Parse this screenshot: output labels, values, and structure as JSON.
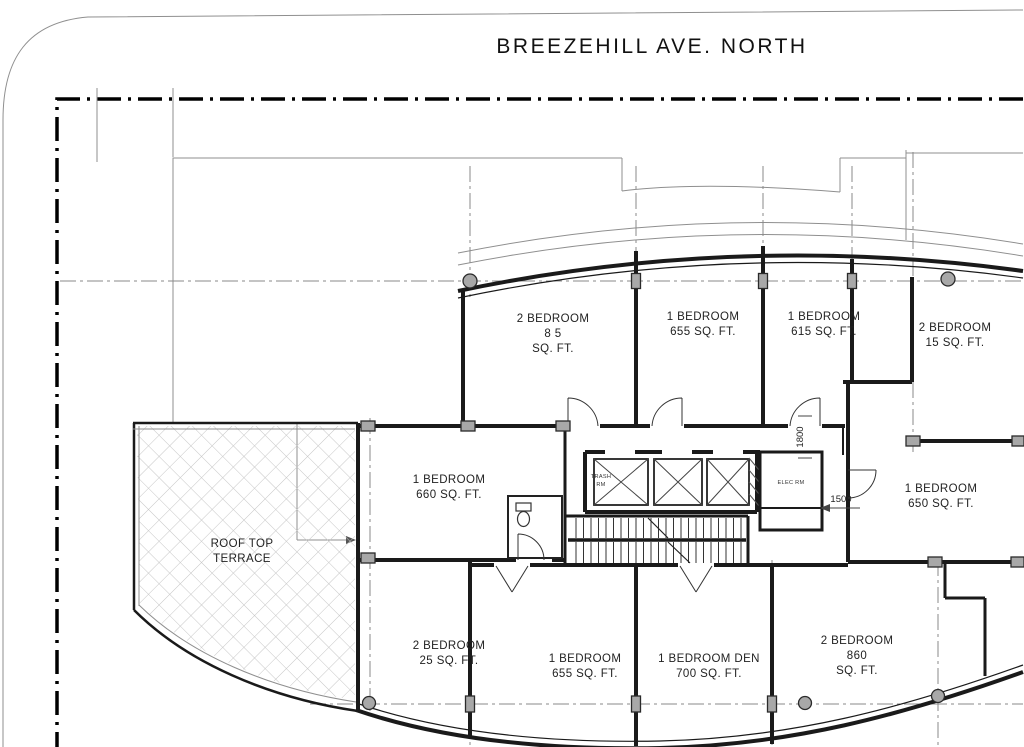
{
  "street": {
    "label": "BREEZEHILL  AVE. NORTH"
  },
  "units": [
    {
      "name": "2-bedroom-835",
      "lines": [
        "2 BEDROOM",
        "8 5",
        "SQ. FT."
      ]
    },
    {
      "name": "1-bedroom-655-top",
      "lines": [
        "1 BEDROOM",
        "655 SQ. FT."
      ]
    },
    {
      "name": "1-bedroom-615",
      "lines": [
        "1 BEDROOM",
        "615 SQ. FT."
      ]
    },
    {
      "name": "2-bedroom-915",
      "lines": [
        "2 BEDROOM",
        "15 SQ. FT."
      ]
    },
    {
      "name": "1-bedroom-660",
      "lines": [
        "1 BEDROOM",
        "660 SQ. FT."
      ]
    },
    {
      "name": "1-bedroom-650",
      "lines": [
        "1 BEDROOM",
        "650 SQ. FT."
      ]
    },
    {
      "name": "roof-top-terrace",
      "lines": [
        "ROOF TOP",
        "TERRACE"
      ]
    },
    {
      "name": "2-bedroom-925",
      "lines": [
        "2 BEDROOM",
        "25 SQ. FT."
      ]
    },
    {
      "name": "1-bedroom-655-bottom",
      "lines": [
        "1 BEDROOM",
        "655 SQ. FT."
      ]
    },
    {
      "name": "1-bedroom-den-700",
      "lines": [
        "1 BEDROOM  DEN",
        "700 SQ. FT."
      ]
    },
    {
      "name": "2-bedroom-860",
      "lines": [
        "2 BEDROOM",
        "860",
        "SQ. FT."
      ]
    }
  ],
  "core": {
    "trash_room_lines": [
      "TRASH",
      "RM"
    ],
    "electrical_room": "ELEC  RM"
  },
  "dimensions": {
    "core_opening": "1800",
    "corridor_width": "1500"
  },
  "colors": {
    "ink": "#1a1a1a",
    "thin_line": "#8f8f8f",
    "column_fill": "#a8a8a8",
    "hatch": "#c6c6c6",
    "background": "#ffffff"
  }
}
